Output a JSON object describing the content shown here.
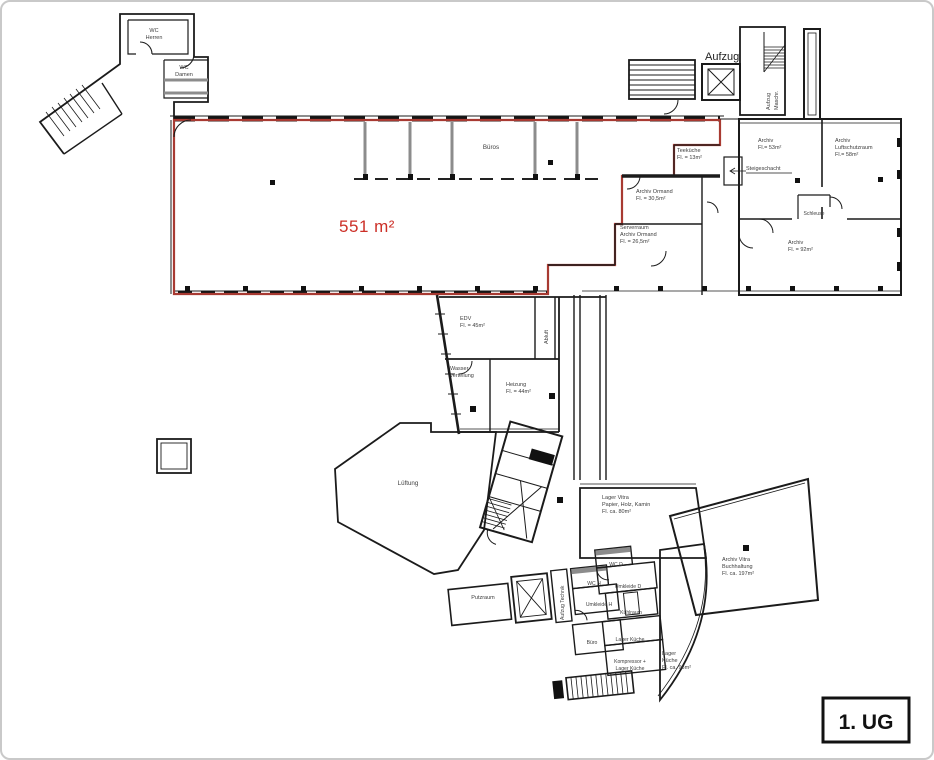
{
  "badge": {
    "label": "1. UG"
  },
  "main_hall": {
    "area": "551 m²"
  },
  "colors": {
    "red_outline": "#a83a32",
    "red_text": "#cc2f27",
    "wall": "#1b1b1b",
    "gray_wall": "#8c8c8c",
    "label": "#3d3d3d"
  },
  "rooms": {
    "wc_herren": [
      "WC",
      "Herren"
    ],
    "wc_damen": [
      "WC",
      "Damen"
    ],
    "aufzug": [
      "Aufzug"
    ],
    "aufzug_maschr": [
      "Aufzug",
      "Maschr."
    ],
    "bueros": [
      "Büros"
    ],
    "teekueche": [
      "Teeküche",
      "Fl. = 13m²"
    ],
    "archiv_ormand": [
      "Archiv Ormand",
      "Fl. = 30,5m²"
    ],
    "serverraum": [
      "Serverraum",
      "Archiv Ormand",
      "Fl. = 26,5m²"
    ],
    "archiv_53": [
      "Archiv",
      "Fl.= 53m²"
    ],
    "archiv_luftschutzraum": [
      "Archiv",
      "Luftschutzraum",
      "Fl.= 58m²"
    ],
    "steigeschacht": [
      "Steigeschacht"
    ],
    "schleuse": [
      "Schleuse"
    ],
    "archiv_92": [
      "Archiv",
      "Fl. = 92m²"
    ],
    "edv": [
      "EDV",
      "Fl. = 45m²"
    ],
    "abluft": [
      "Abluft"
    ],
    "wasserverteilung": [
      "Wasser-",
      "verteilung"
    ],
    "heizung": [
      "Heizung",
      "Fl. = 44m²"
    ],
    "lueftung": [
      "Lüftung"
    ],
    "lager_vitra": [
      "Lager Vitra",
      "Papier, Holz, Kamin",
      "Fl. ca. 80m²"
    ],
    "archiv_vitra": [
      "Archiv Vitra",
      "Buchhaltung",
      "Fl. ca. 197m²"
    ],
    "putzraum": [
      "Putzraum"
    ],
    "aufzug_technik": [
      "Aufzug Technik"
    ],
    "wc_h": [
      "WC H"
    ],
    "umkleide_h": [
      "Umkleide H"
    ],
    "wc_d": [
      "WC D"
    ],
    "umkleide_d": [
      "Umkleide D"
    ],
    "kuehlraum": [
      "Kühlraum"
    ],
    "buero": [
      "Büro"
    ],
    "lager_kueche": [
      "Lager Küche"
    ],
    "kompressor": [
      "Kompressor +",
      "Lager Küche"
    ],
    "lager_kueche_gross": [
      "Lager",
      "Küche",
      "Fl. ca. 98m²"
    ]
  }
}
